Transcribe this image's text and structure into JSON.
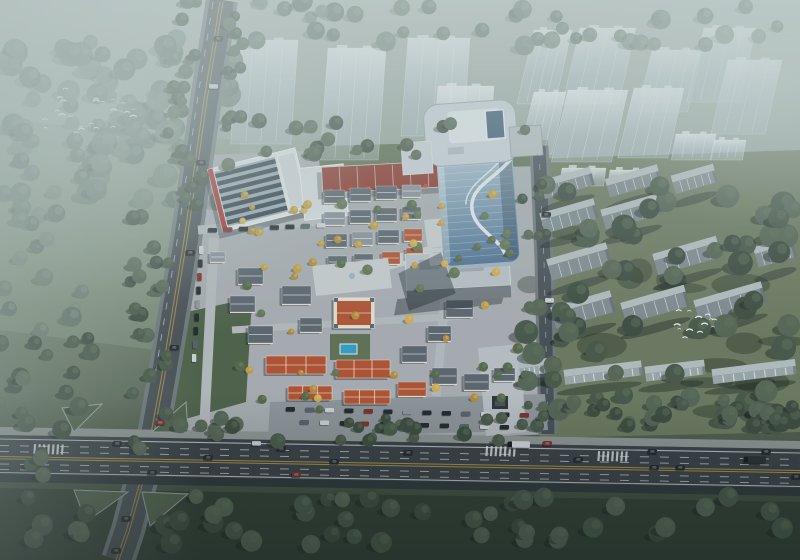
{
  "scene_title": "aerial-masterplan-rendering",
  "palette": {
    "bg_top": "#aeb9b5",
    "bg_mid1": "#93a198",
    "bg_mid2": "#73826f",
    "bg_low": "#4e5c4b",
    "bg_bottom": "#2f3b30",
    "fog": "#c6d2d1",
    "meadow": "#84937f",
    "field_right": "#6b785f",
    "field_bottom": "#303c32",
    "park_green": "#4d5f47",
    "lawn_green": "#5e6f53",
    "tree_dark_1": "#3c4a3e",
    "tree_dark_2": "#475748",
    "tree_dark_3": "#546353",
    "tree_hazy_1": "#5d6f65",
    "tree_hazy_2": "#68796e",
    "tree_hazy_3": "#748579",
    "tree_village_1": "#53664a",
    "tree_village_2": "#5f7351",
    "tree_yellow_1": "#c09c44",
    "tree_yellow_2": "#d0ac52",
    "tree_yellow_3": "#b18a3a",
    "ghost_hi": "#f1f6f8",
    "ghost_lo": "#b3c2cc",
    "slab_top": "#b2bcbf",
    "slab_face": "#7e898e",
    "slab_fin": "#e8edef",
    "road_asphalt": "#454d53",
    "road_sidewalk": "#6e777b",
    "highway_asphalt": "#373e44",
    "highway_edge": "#8f9694",
    "highway_dark": "#2c3338",
    "lane_white": "#ccd2d6",
    "lane_yellow": "#b99a45",
    "island_green": "#4e5f49",
    "site_pavement": "#a7acb1",
    "site_street": "#b3b8bc",
    "plaza": "#c6cbcf",
    "parking": "#8e959a",
    "wall_cream": "#e3dccd",
    "roof_slate": "#5a636d",
    "roof_gray": "#868e98",
    "roof_orange": "#b05130",
    "retail_red": "#8a382e",
    "retail_red_hi": "#c04436",
    "sawtooth_glass": "#2d3944",
    "sawtooth_frame": "#93a7b3",
    "sawtooth_wall": "#dfe3e6",
    "accent_red": "#a52e29",
    "annex_wall": "#ccd3d8",
    "tower_glass_hi": "#a9bfcf",
    "tower_glass_mid": "#7b9ab1",
    "tower_glass_lo": "#4d7093",
    "tower_roof": "#c6d0d7",
    "tower_roof_inner": "#dfe6ea",
    "tower_skylight": "#3d5a73",
    "ribbon": "#eaf0f4",
    "bigslab_top": "#b7bfc5",
    "bigslab_face": "#6e777d",
    "pool": "#2f9ec4",
    "car_dark": "#20262b",
    "car_red": "#7e2d28",
    "car_white": "#ccd2d6",
    "car_gray": "#55606a",
    "bird": "#eef3f4"
  },
  "scene": {
    "ghost_towers": [
      [
        238,
        40,
        60,
        104,
        -4,
        0.8
      ],
      [
        328,
        48,
        58,
        112,
        -4,
        0.84
      ],
      [
        408,
        38,
        62,
        98,
        -4,
        0.78
      ],
      [
        438,
        86,
        56,
        84,
        -4,
        0.86
      ],
      [
        534,
        30,
        38,
        74,
        -13,
        0.78
      ],
      [
        580,
        28,
        56,
        76,
        -13,
        0.8
      ],
      [
        652,
        50,
        50,
        62,
        -13,
        0.76
      ],
      [
        704,
        28,
        52,
        74,
        -13,
        0.78
      ],
      [
        728,
        60,
        54,
        74,
        -13,
        0.8
      ],
      [
        534,
        92,
        32,
        62,
        -13,
        0.84
      ],
      [
        568,
        90,
        60,
        72,
        -13,
        0.84
      ],
      [
        634,
        88,
        50,
        70,
        -13,
        0.82
      ],
      [
        676,
        134,
        40,
        26,
        -10,
        0.9
      ],
      [
        714,
        140,
        32,
        20,
        -10,
        0.9
      ],
      [
        562,
        168,
        44,
        18,
        -8,
        0.88
      ],
      [
        610,
        170,
        38,
        16,
        -8,
        0.88
      ]
    ],
    "slabs": [
      [
        570,
        192,
        52,
        12,
        -16
      ],
      [
        636,
        190,
        54,
        12,
        -16
      ],
      [
        697,
        188,
        44,
        12,
        -16
      ],
      [
        572,
        226,
        56,
        14,
        -16
      ],
      [
        634,
        222,
        58,
        14,
        -16
      ],
      [
        582,
        272,
        62,
        15,
        -16
      ],
      [
        690,
        266,
        66,
        15,
        -16
      ],
      [
        778,
        262,
        40,
        14,
        -16
      ],
      [
        586,
        320,
        62,
        15,
        -16
      ],
      [
        658,
        315,
        66,
        15,
        -16
      ],
      [
        733,
        312,
        70,
        15,
        -16
      ]
    ],
    "low_slabs": [
      [
        540,
        374,
        40,
        8,
        -7
      ],
      [
        604,
        380,
        78,
        8,
        -7
      ],
      [
        676,
        378,
        60,
        8,
        -7
      ],
      [
        755,
        379,
        84,
        8,
        -7
      ]
    ],
    "houses": [
      [
        324,
        190,
        21,
        13,
        "slate"
      ],
      [
        350,
        188,
        21,
        13,
        "slate"
      ],
      [
        376,
        186,
        21,
        13,
        "slate"
      ],
      [
        402,
        185,
        19,
        12,
        "gray"
      ],
      [
        324,
        212,
        21,
        13,
        "gray"
      ],
      [
        350,
        210,
        21,
        13,
        "slate"
      ],
      [
        376,
        208,
        21,
        13,
        "slate"
      ],
      [
        402,
        207,
        19,
        12,
        "slate"
      ],
      [
        326,
        234,
        21,
        13,
        "slate"
      ],
      [
        352,
        232,
        21,
        13,
        "gray"
      ],
      [
        378,
        230,
        21,
        13,
        "slate"
      ],
      [
        404,
        229,
        18,
        12,
        "orange"
      ],
      [
        328,
        256,
        19,
        12,
        "slate"
      ],
      [
        354,
        254,
        19,
        12,
        "slate"
      ],
      [
        382,
        252,
        18,
        12,
        "orange"
      ],
      [
        406,
        248,
        17,
        11,
        "orange"
      ],
      [
        238,
        268,
        25,
        16,
        "slate"
      ],
      [
        230,
        296,
        25,
        16,
        "slate"
      ],
      [
        248,
        326,
        25,
        17,
        "slate"
      ],
      [
        282,
        286,
        29,
        18,
        "slate"
      ],
      [
        300,
        318,
        22,
        14,
        "slate"
      ],
      [
        334,
        298,
        40,
        30,
        "chateau"
      ],
      [
        266,
        356,
        60,
        18,
        "orange3"
      ],
      [
        336,
        360,
        54,
        18,
        "orange3"
      ],
      [
        402,
        346,
        25,
        16,
        "slate"
      ],
      [
        428,
        326,
        23,
        15,
        "slate"
      ],
      [
        446,
        300,
        27,
        17,
        "slate"
      ],
      [
        458,
        272,
        23,
        15,
        "slate"
      ],
      [
        288,
        386,
        44,
        14,
        "orange3"
      ],
      [
        344,
        390,
        46,
        14,
        "orange3"
      ],
      [
        398,
        382,
        28,
        14,
        "orange"
      ],
      [
        432,
        368,
        25,
        16,
        "slate"
      ],
      [
        464,
        374,
        25,
        16,
        "slate"
      ],
      [
        494,
        368,
        21,
        13,
        "slate"
      ],
      [
        210,
        252,
        15,
        10,
        "gray"
      ]
    ],
    "tree_clusters": [
      {
        "x": 0,
        "y": 38,
        "w": 235,
        "h": 165,
        "n": 85,
        "rmin": 7,
        "rmax": 13,
        "kind": "hazy",
        "seed": 11,
        "layer": "haze"
      },
      {
        "x": 0,
        "y": 205,
        "w": 135,
        "h": 140,
        "n": 16,
        "rmin": 6,
        "rmax": 10,
        "kind": "hazy",
        "seed": 12,
        "layer": "haze"
      },
      {
        "x": 238,
        "y": 0,
        "w": 562,
        "h": 46,
        "n": 40,
        "rmin": 6,
        "rmax": 10,
        "kind": "hazy",
        "seed": 13,
        "layer": "haze"
      },
      {
        "x": 166,
        "y": 0,
        "w": 40,
        "h": 205,
        "n": 22,
        "rmin": 5,
        "rmax": 8,
        "kind": "dark",
        "seed": 14,
        "layer": "front"
      },
      {
        "x": 226,
        "y": 8,
        "w": 24,
        "h": 165,
        "n": 14,
        "rmin": 4,
        "rmax": 7,
        "kind": "dark",
        "seed": 15,
        "layer": "front"
      },
      {
        "x": 126,
        "y": 212,
        "w": 44,
        "h": 246,
        "n": 22,
        "rmin": 5,
        "rmax": 8,
        "kind": "dark",
        "seed": 16,
        "layer": "front"
      },
      {
        "x": 240,
        "y": 118,
        "w": 300,
        "h": 44,
        "n": 16,
        "rmin": 5,
        "rmax": 8,
        "kind": "dark",
        "seed": 17,
        "layer": "front"
      },
      {
        "x": 522,
        "y": 176,
        "w": 278,
        "h": 248,
        "n": 58,
        "rmin": 8,
        "rmax": 13,
        "kind": "dark",
        "seed": 18,
        "layer": "front"
      },
      {
        "x": 180,
        "y": 418,
        "w": 362,
        "h": 24,
        "n": 26,
        "rmin": 5,
        "rmax": 8,
        "kind": "dark",
        "seed": 19,
        "layer": "front"
      },
      {
        "x": 545,
        "y": 398,
        "w": 255,
        "h": 28,
        "n": 24,
        "rmin": 6,
        "rmax": 9,
        "kind": "dark",
        "seed": 20,
        "layer": "front"
      },
      {
        "x": 0,
        "y": 496,
        "w": 800,
        "h": 52,
        "n": 46,
        "rmin": 7,
        "rmax": 11,
        "kind": "dark",
        "seed": 21,
        "layer": "front"
      },
      {
        "x": 0,
        "y": 336,
        "w": 118,
        "h": 155,
        "n": 20,
        "rmin": 6,
        "rmax": 10,
        "kind": "dark",
        "seed": 22,
        "layer": "front"
      },
      {
        "x": 520,
        "y": 182,
        "w": 26,
        "h": 246,
        "n": 12,
        "rmin": 4,
        "rmax": 6,
        "kind": "dark",
        "seed": 23,
        "layer": "front"
      },
      {
        "x": 220,
        "y": 182,
        "w": 300,
        "h": 236,
        "n": 24,
        "rmin": 3.5,
        "rmax": 5.5,
        "kind": "village",
        "seed": 24,
        "layer": "front"
      },
      {
        "x": 228,
        "y": 186,
        "w": 278,
        "h": 228,
        "n": 36,
        "rmin": 2.8,
        "rmax": 4.6,
        "kind": "yellow",
        "seed": 25,
        "layer": "front"
      },
      {
        "x": 428,
        "y": 198,
        "w": 96,
        "h": 66,
        "n": 6,
        "rmin": 3,
        "rmax": 4.5,
        "kind": "village",
        "seed": 26,
        "layer": "front"
      }
    ],
    "shadow_patches": {
      "x": 528,
      "y": 192,
      "w": 266,
      "h": 228,
      "n": 16,
      "seed": 31
    },
    "cars": {
      "highway": [
        [
          113,
          441,
          "d"
        ],
        [
          148,
          470,
          "d"
        ],
        [
          204,
          455,
          "d"
        ],
        [
          252,
          441,
          "w"
        ],
        [
          277,
          446,
          "d"
        ],
        [
          292,
          472,
          "r"
        ],
        [
          330,
          459,
          "d"
        ],
        [
          404,
          450,
          "d"
        ],
        [
          508,
          441,
          "tw"
        ],
        [
          543,
          441,
          "r"
        ],
        [
          574,
          457,
          "d"
        ],
        [
          648,
          449,
          "d"
        ],
        [
          650,
          465,
          "d"
        ],
        [
          676,
          465,
          "d"
        ],
        [
          744,
          456,
          "td"
        ],
        [
          762,
          449,
          "d"
        ],
        [
          792,
          474,
          "d"
        ]
      ],
      "left_road": [
        [
          214,
          36,
          "d"
        ],
        [
          209,
          84,
          "w"
        ],
        [
          197,
          160,
          "d"
        ],
        [
          186,
          250,
          "d"
        ],
        [
          170,
          345,
          "d"
        ],
        [
          156,
          420,
          "r"
        ],
        [
          122,
          516,
          "d"
        ],
        [
          112,
          548,
          "d"
        ]
      ],
      "street": [
        [
          542,
          212,
          "d"
        ],
        [
          545,
          298,
          "w"
        ],
        [
          548,
          368,
          "d"
        ]
      ]
    },
    "parked_rows": [
      {
        "x": 286,
        "y": 407,
        "n": 13,
        "dx": 19.5,
        "dy": 0.5,
        "vert": false
      },
      {
        "x": 300,
        "y": 420,
        "n": 11,
        "dx": 20,
        "dy": 0.5,
        "vert": false
      },
      {
        "x": 199,
        "y": 246,
        "n": 9,
        "dx": -0.9,
        "dy": 13.5,
        "vert": true
      },
      {
        "x": 208,
        "y": 228,
        "n": 8,
        "dx": 15.5,
        "dy": -0.7,
        "vert": false
      }
    ],
    "zebras": [
      {
        "x": 34,
        "y": 444,
        "n": 7
      },
      {
        "x": 486,
        "y": 446,
        "n": 7
      },
      {
        "x": 598,
        "y": 451,
        "n": 7
      }
    ],
    "birds": [
      {
        "cx": 92,
        "cy": 112,
        "sx": 100,
        "sy": 46,
        "n": 24,
        "seed": 41
      },
      {
        "cx": 700,
        "cy": 326,
        "sx": 46,
        "sy": 34,
        "n": 13,
        "seed": 42
      }
    ]
  }
}
